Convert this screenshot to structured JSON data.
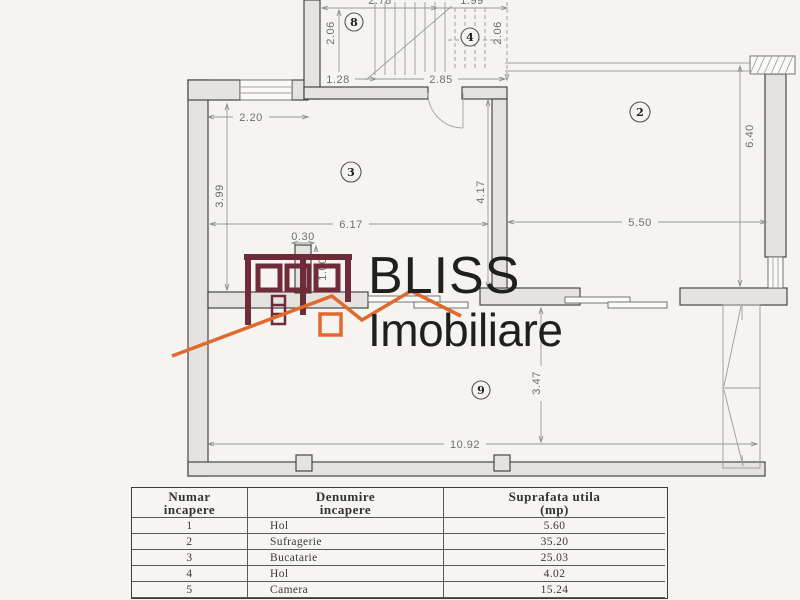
{
  "logo": {
    "title": "BLISS",
    "subtitle": "Imobiliare",
    "house_color": "#6f2b38",
    "roof_color": "#e06a2e"
  },
  "plan": {
    "labels": {
      "room2": "2",
      "room3": "3",
      "room4": "4",
      "room8": "8",
      "room9": "9"
    },
    "dims": {
      "top_left": "2.78",
      "top_right": "1.99",
      "stairs_left": "2.06",
      "stairs_right": "2.06",
      "stairs_bottom_left": "1.28",
      "stairs_bottom_right": "2.85",
      "room3_top": "2.20",
      "room3_left": "3.99",
      "room3_width": "6.17",
      "pillar_width": "0.30",
      "pillar_height": "1.00",
      "room3_right": "4.17",
      "room2_width": "5.50",
      "room2_height": "6.40",
      "room9_height": "3.47",
      "room9_width": "10.92"
    }
  },
  "table": {
    "headers": [
      {
        "line1": "Numar",
        "line2": "incapere"
      },
      {
        "line1": "Denumire",
        "line2": "incapere"
      },
      {
        "line1": "Suprafata  utila",
        "line2": "(mp)"
      }
    ],
    "rows": [
      [
        "1",
        "Hol",
        "5.60"
      ],
      [
        "2",
        "Sufragerie",
        "35.20"
      ],
      [
        "3",
        "Bucatarie",
        "25.03"
      ],
      [
        "4",
        "Hol",
        "4.02"
      ],
      [
        "5",
        "Camera",
        "15.24"
      ]
    ]
  }
}
